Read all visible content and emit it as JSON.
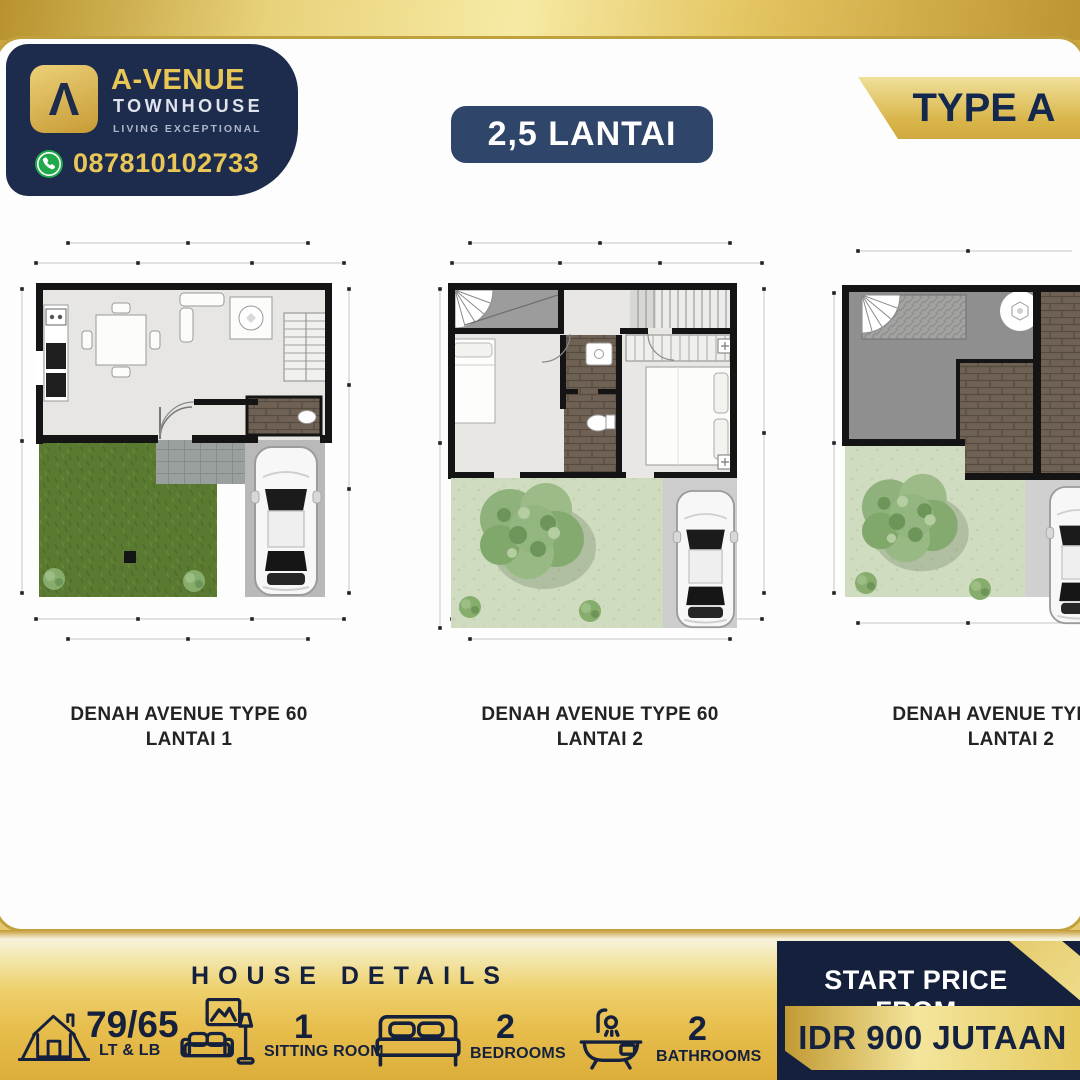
{
  "brand": {
    "logo_glyph": "Λ",
    "name": "A-VENUE",
    "subtitle": "TOWNHOUSE",
    "tagline": "LIVING EXCEPTIONAL",
    "phone": "087810102733"
  },
  "header": {
    "floors_badge": "2,5 LANTAI",
    "type_badge": "TYPE A"
  },
  "plans": [
    {
      "line1": "DENAH AVENUE TYPE 60",
      "line2": "LANTAI 1"
    },
    {
      "line1": "DENAH AVENUE TYPE 60",
      "line2": "LANTAI 2"
    },
    {
      "line1": "DENAH AVENUE TYPE 60",
      "line2": "LANTAI 2"
    }
  ],
  "footer": {
    "title": "HOUSE DETAILS",
    "stats": [
      {
        "icon": "house-icon",
        "value": "79/65",
        "label": "LT & LB"
      },
      {
        "icon": "sitting-room-icon",
        "value": "1",
        "label": "SITTING ROOM"
      },
      {
        "icon": "bed-icon",
        "value": "2",
        "label": "BEDROOMS"
      },
      {
        "icon": "bathtub-icon",
        "value": "2",
        "label": "BATHROOMS"
      }
    ],
    "price": {
      "label": "START PRICE FROM",
      "value": "IDR 900 JUTAAN"
    }
  },
  "colors": {
    "navy": "#1d2b4d",
    "price_navy": "#15213c",
    "gold": "#d9b54a",
    "gold_text": "#e8c757",
    "whatsapp_green": "#1fa94a",
    "lawn_dark": "#5b7a31",
    "lawn_pale": "#cfdcc0"
  }
}
